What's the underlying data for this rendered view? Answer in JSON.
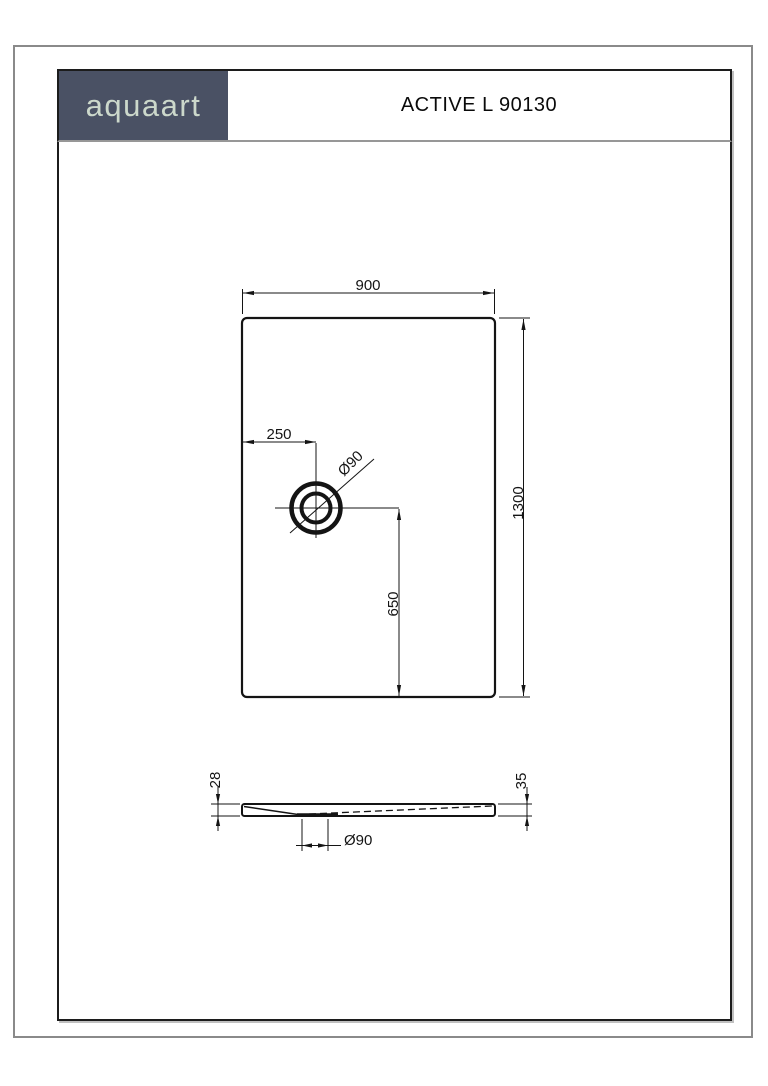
{
  "header": {
    "logo_text": "aquaart",
    "title": "ACTIVE L 90130"
  },
  "colors": {
    "logo_background": "#4a5164",
    "logo_text": "#ccd8cb",
    "line": "#141414",
    "frame": "#1c1c1c",
    "band_rule": "#979797"
  },
  "top_view": {
    "width_dim": "900",
    "height_dim": "1300",
    "drain_offset_from_left_dim": "250",
    "drain_offset_to_bottom_dim": "650",
    "drain_diameter_label": "Ø90"
  },
  "side_view": {
    "left_edge_height_dim": "28",
    "right_edge_height_dim": "35",
    "drain_diameter_label": "Ø90"
  }
}
